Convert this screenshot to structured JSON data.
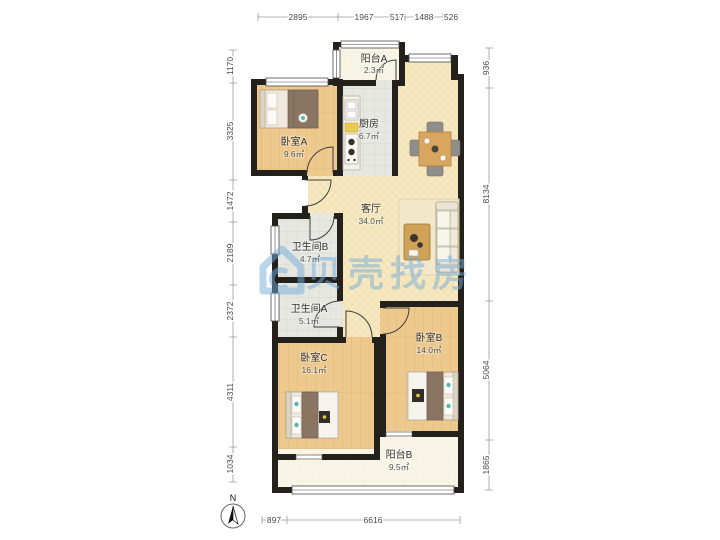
{
  "watermark": {
    "text": "贝壳找房"
  },
  "compass": {
    "north_label": "N"
  },
  "rooms": [
    {
      "name": "阳台A",
      "area": "2.3㎡"
    },
    {
      "name": "厨房",
      "area": "6.7㎡"
    },
    {
      "name": "卧室A",
      "area": "9.6㎡"
    },
    {
      "name": "客厅",
      "area": "34.0㎡"
    },
    {
      "name": "卫生间B",
      "area": "4.7㎡"
    },
    {
      "name": "卫生间A",
      "area": "5.1㎡"
    },
    {
      "name": "卧室C",
      "area": "16.1㎡"
    },
    {
      "name": "卧室B",
      "area": "14.0㎡"
    },
    {
      "name": "阳台B",
      "area": "9.5㎡"
    }
  ],
  "dimensions": {
    "top": [
      "2895",
      "1967",
      "517",
      "1488",
      "526"
    ],
    "left": [
      "1170",
      "3325",
      "1472",
      "2189",
      "2372",
      "4311",
      "1034"
    ],
    "right": [
      "936",
      "8134",
      "5064",
      "1865"
    ],
    "bottom": [
      "897",
      "6616"
    ]
  },
  "colors": {
    "wall": "#24211d",
    "wood-floor": "#eec98d",
    "living-floor": "#f6e8c1",
    "tile-floor": "#e7e7e2",
    "balcony-floor": "#f8f5e6",
    "watermark-blue": "#74add9",
    "accent-teal": "#55b7b1",
    "blanket-brown": "#8a7563",
    "table-wood": "#d9a660"
  }
}
